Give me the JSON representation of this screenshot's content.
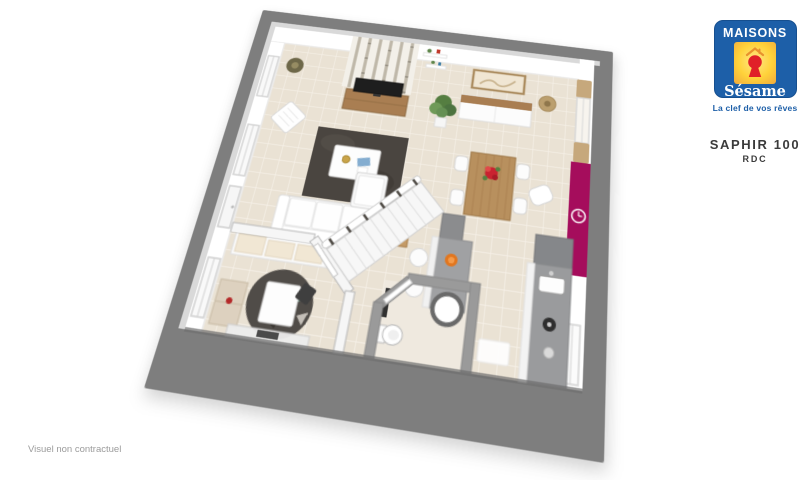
{
  "brand": {
    "name_top": "MAISONS",
    "name_script": "Sésame",
    "tagline": "La clef de vos rêves"
  },
  "model": {
    "name": "SAPHIR 100",
    "floor": "RDC"
  },
  "footer": {
    "disclaimer": "Visuel non contractuel"
  },
  "theme": {
    "logo-blue": "#1d5fa8",
    "logo-yellow": "#ffd23a",
    "logo-red": "#e02028",
    "accent-magenta": "#a50d5c",
    "slab-gray": "#7e7e7e",
    "floor-cream": "#eae2d4",
    "wood": "#a97e52",
    "counter-gray": "#9a9b9d",
    "rug-dark": "#4a4540",
    "plant-green": "#5d8549",
    "text-dark": "#3b3b3b",
    "text-gray": "#9b9b9b"
  }
}
